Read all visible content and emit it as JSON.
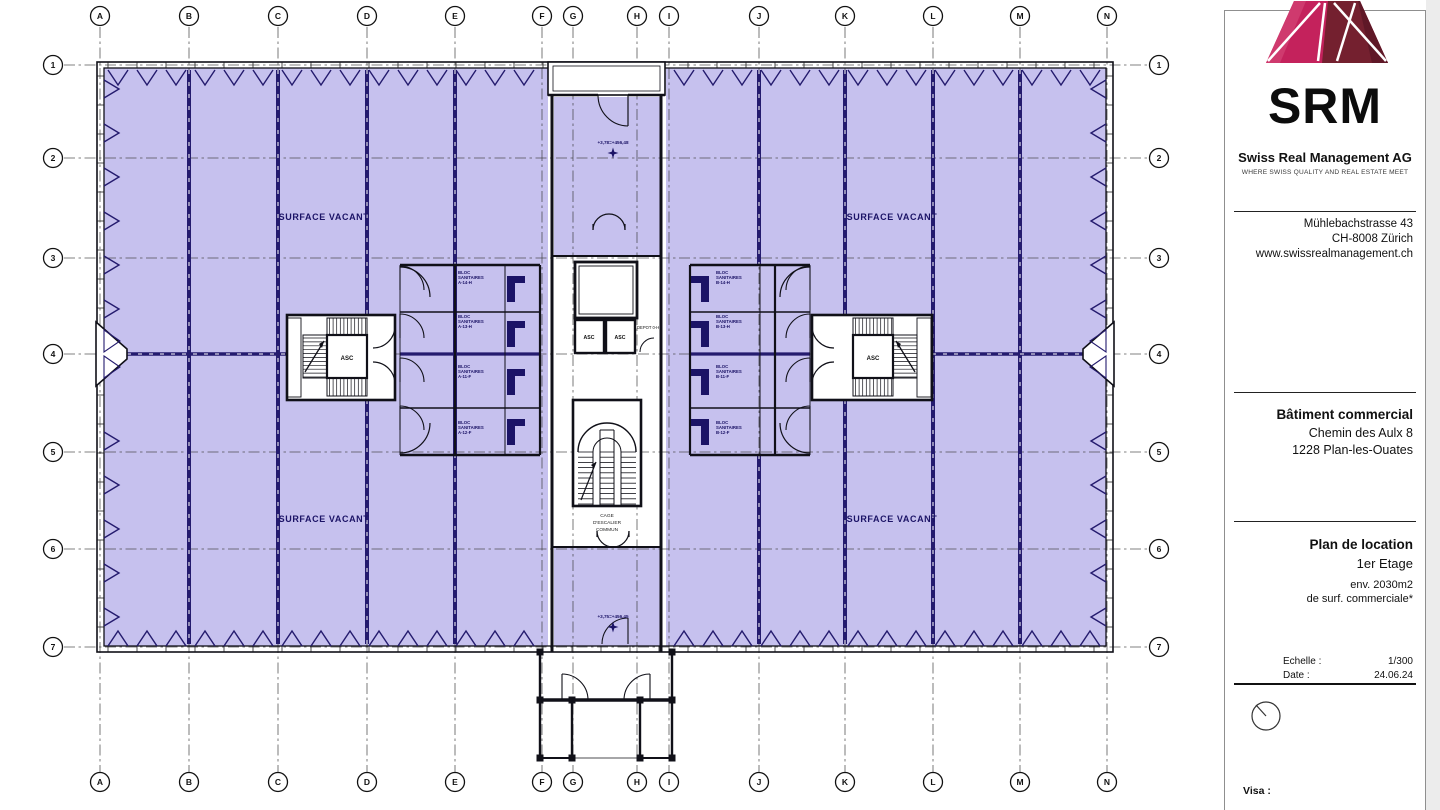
{
  "sidebar": {
    "logo_text": "SRM",
    "company": "Swiss Real Management AG",
    "tagline": "WHERE SWISS QUALITY AND REAL ESTATE MEET",
    "address": [
      "Mühlebachstrasse 43",
      "CH-8008 Zürich",
      "www.swissrealmanagement.ch"
    ],
    "building": {
      "title": "Bâtiment commercial",
      "line1": "Chemin des Aulx 8",
      "line2": "1228 Plan-les-Ouates"
    },
    "plan": {
      "title": "Plan de location",
      "floor": "1er Etage",
      "area1": "env. 2030m2",
      "area2": "de surf. commerciale*"
    },
    "meta": {
      "scale_label": "Echelle :",
      "scale": "1/300",
      "date_label": "Date :",
      "date": "24.06.24"
    },
    "visa_label": "Visa :"
  },
  "plan": {
    "grid": {
      "column_labels": [
        "A",
        "B",
        "C",
        "D",
        "E",
        "F",
        "G",
        "H",
        "I",
        "J",
        "K",
        "L",
        "M",
        "N"
      ],
      "row_labels": [
        "1",
        "2",
        "3",
        "4",
        "5",
        "6",
        "7"
      ]
    },
    "labels": {
      "surface_vacant": "SURFACE VACANT",
      "asc": "ASC",
      "depot": "DEPOT 0-H",
      "cage_lines": [
        "CAGE",
        "D'ESCALIER",
        "COMMUN"
      ],
      "level_top": "+3,78=+456,48",
      "level_bottom": "+3,75=+456,45"
    },
    "sanitaires": {
      "line1": "BLOC",
      "line2": "SANITAIRES",
      "left_codes": [
        "A-14-H",
        "A-13-H",
        "A-11-F",
        "A-12-F"
      ],
      "right_codes": [
        "B-14-H",
        "B-13-H",
        "B-11-F",
        "B-12-F"
      ]
    },
    "colors": {
      "surface_fill": "#c6c1ee",
      "line_navy": "#241b6e",
      "text_navy": "#1b1366",
      "wall": "#101018",
      "logo_pink": "#c4225c",
      "logo_maroon": "#74202f"
    }
  }
}
